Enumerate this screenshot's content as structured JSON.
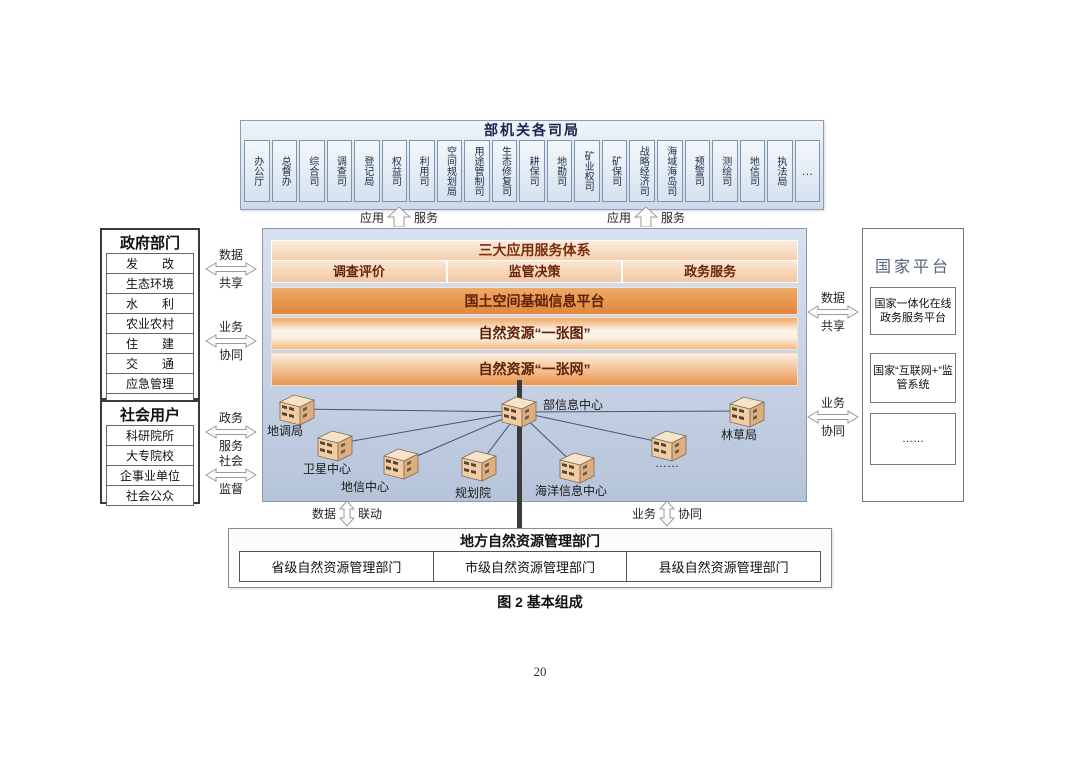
{
  "page": {
    "caption": "图 2  基本组成",
    "page_number": "20"
  },
  "ministry": {
    "title": "部机关各司局",
    "departments": [
      "办公厅",
      "总督办",
      "综合司",
      "调查司",
      "登记局",
      "权益司",
      "利用司",
      "空间规划局",
      "用途管制司",
      "生态修复司",
      "耕保司",
      "地勘司",
      "矿业权司",
      "矿保司",
      "战略经济司",
      "海域海岛司",
      "预警司",
      "测绘司",
      "地信司",
      "执法局",
      "…"
    ]
  },
  "top_links": {
    "app": "应用",
    "svc": "服务"
  },
  "government": {
    "title": "政府部门",
    "items": [
      "发　　改",
      "生态环境",
      "水　　利",
      "农业农村",
      "住　　建",
      "交　　通",
      "应急管理",
      "……"
    ]
  },
  "social": {
    "title": "社会用户",
    "items": [
      "科研院所",
      "大专院校",
      "企事业单位",
      "社会公众"
    ]
  },
  "left_arrows": [
    {
      "top": "数据",
      "bottom": "共享"
    },
    {
      "top": "业务",
      "bottom": "协同"
    },
    {
      "top": "政务",
      "bottom": "服务"
    },
    {
      "top": "社会",
      "bottom": "监督"
    }
  ],
  "right_arrows": [
    {
      "top": "数据",
      "bottom": "共享"
    },
    {
      "top": "业务",
      "bottom": "协同"
    }
  ],
  "platform": {
    "header": "三大应用服务体系",
    "services": [
      "调查评价",
      "监管决策",
      "政务服务"
    ],
    "bars": [
      "国土空间基础信息平台",
      "自然资源“一张图”",
      "自然资源“一张网”"
    ],
    "nodes": [
      {
        "label": "地调局"
      },
      {
        "label": "卫星中心"
      },
      {
        "label": "地信中心"
      },
      {
        "label": "规划院"
      },
      {
        "label": "部信息中心"
      },
      {
        "label": "海洋信息中心"
      },
      {
        "label": "……"
      },
      {
        "label": "林草局"
      }
    ]
  },
  "national": {
    "title": "国家平台",
    "items": [
      "国家一体化在线政务服务平台",
      "国家“互联网+”监管系统",
      "……"
    ]
  },
  "bottom_arrows": [
    {
      "left": "数据",
      "right": "联动"
    },
    {
      "left": "业务",
      "right": "协同"
    }
  ],
  "local": {
    "title": "地方自然资源管理部门",
    "cells": [
      "省级自然资源管理部门",
      "市级自然资源管理部门",
      "县级自然资源管理部门"
    ]
  },
  "colors": {
    "bar_orange": "#e0873c",
    "platform_bg": "#c4d0e2",
    "ministry_bg": "#d5e1ee",
    "building_tan": "#f2cda2"
  }
}
